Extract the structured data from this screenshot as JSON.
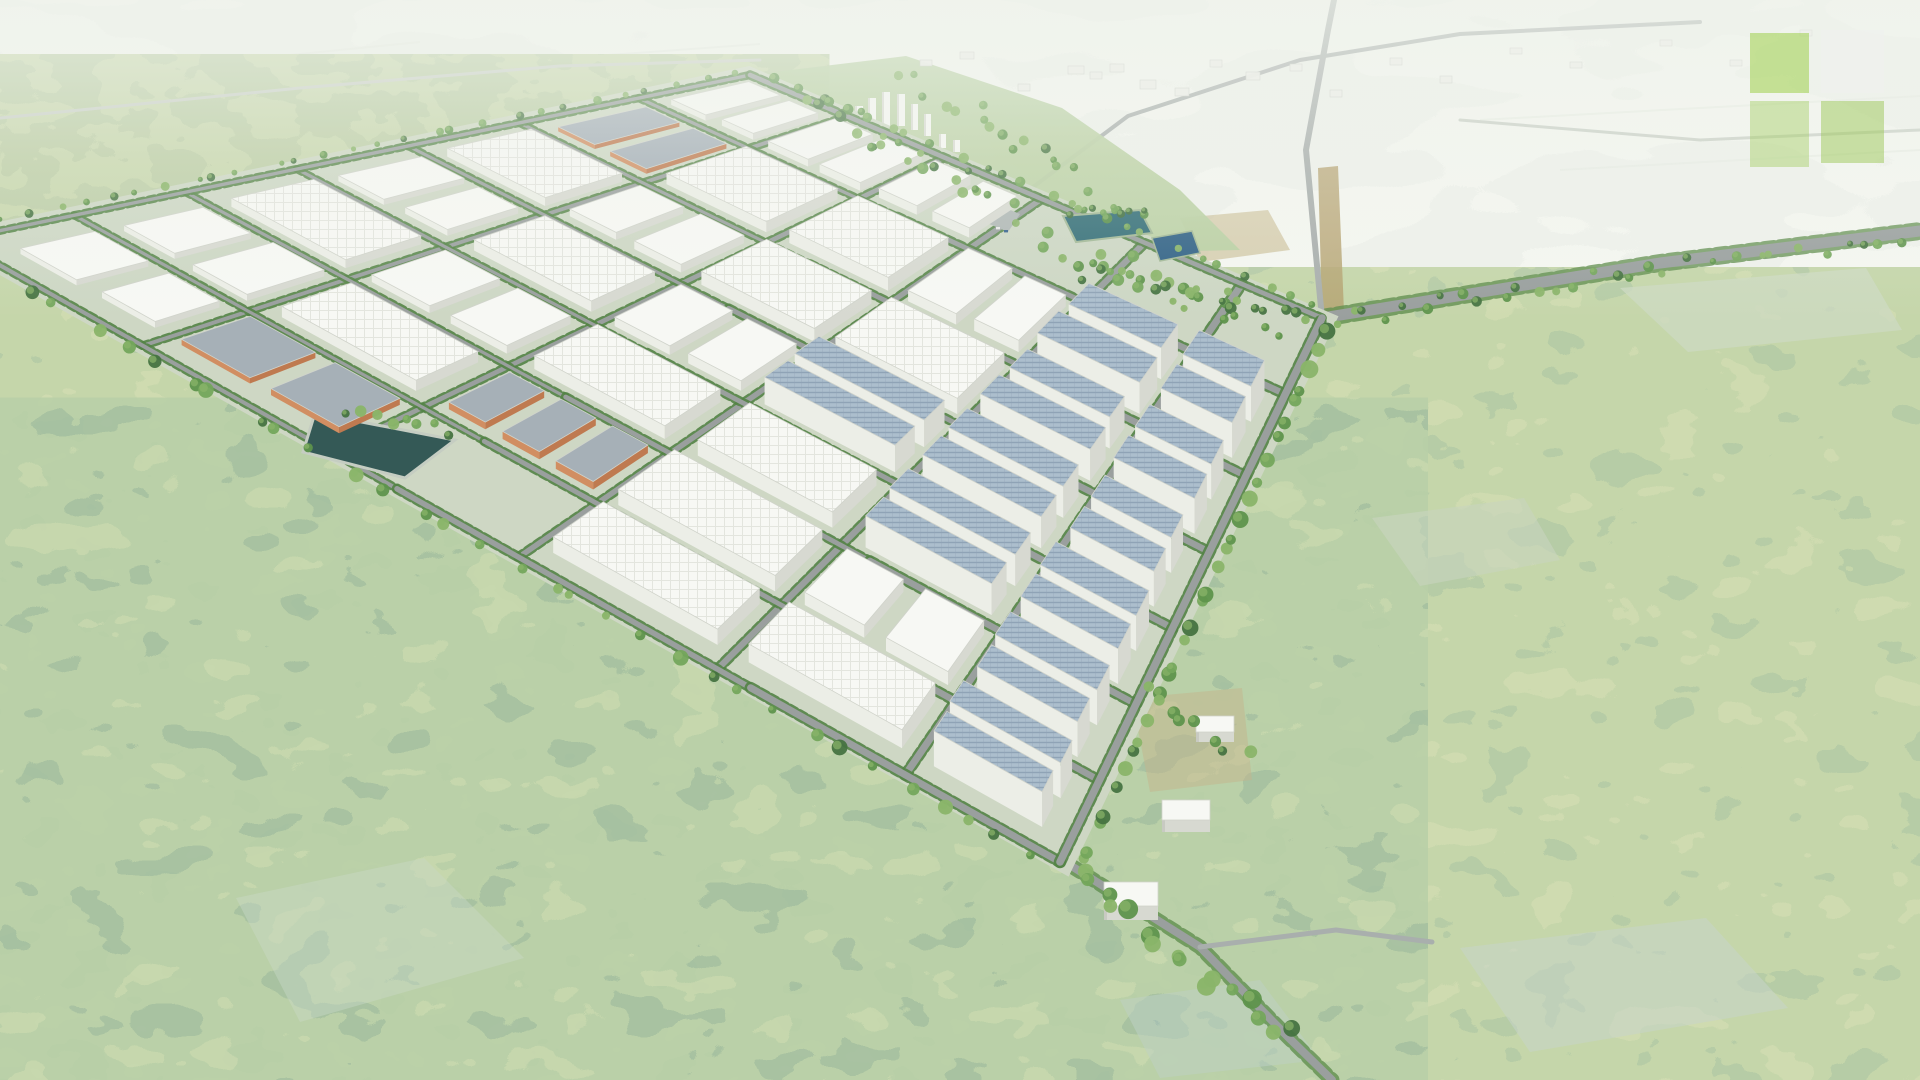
{
  "scene": {
    "alt": "Aerial 3D rendering of a planned industrial park with white warehouse blocks, orange buildings, solar rooftops, a street grid, retention ponds, surrounded by farmland and forest",
    "seed": 20240701
  },
  "palette": {
    "park_base": "#ccd6c2",
    "road": "#969c9b",
    "road_minor": "#a6acaa",
    "road_faint": "#c9cfc6",
    "hedge": "#4c7e3e",
    "verge": "#5a8a47",
    "white_roof": "#f7f8f4",
    "white_front": "#d6d8d0",
    "white_left": "#eceee6",
    "roof_line": "#e2e4dd",
    "orange_front": "#bd7549",
    "orange_left": "#d08a5c",
    "orange_roof": "#a3adb5",
    "solar_roof": "#a9bccb",
    "solar_stripe": "#8ba0b4",
    "pond": "#2c5350",
    "pond_edge": "#c3cbc0",
    "lake_a": "#2e6a74",
    "lake_b": "#2a5d82",
    "zone_green": "#b7cfa0",
    "plaza": "#aeb6b4",
    "tower_face": "#f6f7f3",
    "tower_shade": "#d8dad2",
    "trees": [
      "#3e6e3a",
      "#578f45",
      "#6fa355",
      "#86b264"
    ],
    "car_colors": [
      "#3c4450",
      "#a23b32",
      "#e8e8e8",
      "#2f5d8a",
      "#555555"
    ],
    "streak": "#e6ebe2",
    "haze": "238,242,235"
  },
  "filters": [
    {
      "id": "farmF",
      "freq": "0.005 0.013",
      "oct": 3,
      "seed": 11,
      "palette": [
        "#cdd8c7",
        "#dbe2d4",
        "#e7ebe0",
        "#c2cfbe"
      ]
    },
    {
      "id": "oliveF",
      "freq": "0.02 0.032",
      "oct": 3,
      "seed": 5,
      "palette": [
        "#6b8a52",
        "#7f9b5f",
        "#93ad68",
        "#a2b573"
      ]
    },
    {
      "id": "forestF",
      "freq": "0.017 0.027",
      "oct": 3,
      "seed": 7,
      "palette": [
        "#50794f",
        "#74985e",
        "#8caa64",
        "#9db36a",
        "#567e68"
      ]
    },
    {
      "id": "tealF",
      "freq": "0.015 0.025",
      "oct": 3,
      "seed": 9,
      "palette": [
        "#3d654d",
        "#5c8458",
        "#79a061",
        "#8fae68",
        "#4b7566"
      ]
    }
  ],
  "quad": {
    "W": [
      -45,
      240
    ],
    "N": [
      750,
      75
    ],
    "E": [
      1322,
      318
    ],
    "S": [
      1060,
      862
    ]
  },
  "grid": {
    "ucuts": [
      0.02,
      0.15,
      0.29,
      0.43,
      0.57,
      0.71,
      0.86,
      0.99
    ],
    "vcuts": [
      0.02,
      0.17,
      0.34,
      0.51,
      0.69,
      0.86,
      0.99
    ],
    "cellmap": [
      "2 2 1 2 1 o 2",
      "o 1 2 1 2 1 2",
      "p O 1 2 1 1 2",
      "1 1 1 r 1 2 g",
      "1 2 r r r r g",
      "r r r r r r g"
    ],
    "heights": {
      "shed": 14,
      "slab": 10,
      "orange": 8,
      "solar": 24
    }
  },
  "zones": {
    "farmland": [
      [
        0,
        0
      ],
      [
        1920,
        0
      ],
      [
        1920,
        240
      ],
      [
        1600,
        254
      ],
      [
        1380,
        240
      ],
      [
        1160,
        250
      ],
      [
        1040,
        222
      ],
      [
        900,
        140
      ],
      [
        760,
        66
      ],
      [
        520,
        98
      ],
      [
        240,
        142
      ],
      [
        0,
        178
      ]
    ],
    "olive_band": [
      [
        0,
        176
      ],
      [
        240,
        140
      ],
      [
        520,
        96
      ],
      [
        740,
        64
      ],
      [
        790,
        84
      ],
      [
        520,
        146
      ],
      [
        240,
        210
      ],
      [
        0,
        262
      ]
    ],
    "teal_overlay": [
      [
        0,
        430
      ],
      [
        310,
        440
      ],
      [
        700,
        640
      ],
      [
        1000,
        860
      ],
      [
        1360,
        1080
      ],
      [
        0,
        1080
      ]
    ],
    "town_green": [
      [
        758,
        74
      ],
      [
        906,
        56
      ],
      [
        1062,
        108
      ],
      [
        1180,
        190
      ],
      [
        1240,
        250
      ],
      [
        1150,
        252
      ],
      [
        1002,
        206
      ],
      [
        848,
        112
      ]
    ]
  },
  "clearings": [
    {
      "pts": [
        [
          1620,
          288
        ],
        [
          1866,
          268
        ],
        [
          1902,
          330
        ],
        [
          1688,
          352
        ]
      ],
      "c": "#cbd8c0",
      "o": 0.75
    },
    {
      "pts": [
        [
          1372,
          518
        ],
        [
          1524,
          498
        ],
        [
          1560,
          560
        ],
        [
          1420,
          586
        ]
      ],
      "c": "#c6d4bd",
      "o": 0.6
    },
    {
      "pts": [
        [
          1460,
          948
        ],
        [
          1706,
          918
        ],
        [
          1788,
          1008
        ],
        [
          1530,
          1052
        ]
      ],
      "c": "#c4d4c9",
      "o": 0.55
    },
    {
      "pts": [
        [
          236,
          898
        ],
        [
          424,
          858
        ],
        [
          524,
          958
        ],
        [
          300,
          1022
        ]
      ],
      "c": "#c7d6c4",
      "o": 0.45
    },
    {
      "pts": [
        [
          1120,
          1000
        ],
        [
          1260,
          980
        ],
        [
          1320,
          1060
        ],
        [
          1160,
          1078
        ]
      ],
      "c": "#bccfc4",
      "o": 0.5
    }
  ],
  "dirt_patches": [
    {
      "pts": [
        [
          1318,
          168
        ],
        [
          1338,
          166
        ],
        [
          1344,
          312
        ],
        [
          1322,
          314
        ]
      ],
      "c": "#b3a06c",
      "o": 0.85
    },
    {
      "pts": [
        [
          1132,
          698
        ],
        [
          1242,
          688
        ],
        [
          1252,
          780
        ],
        [
          1150,
          792
        ]
      ],
      "c": "#c2b288",
      "o": 0.5
    },
    {
      "pts": [
        [
          1180,
          218
        ],
        [
          1268,
          210
        ],
        [
          1290,
          250
        ],
        [
          1200,
          262
        ]
      ],
      "c": "#bfae7e",
      "o": 0.55
    }
  ],
  "streaks": [
    [
      0,
      128,
      520,
      74
    ],
    [
      60,
      176,
      640,
      108
    ],
    [
      0,
      84,
      420,
      42
    ],
    [
      540,
      60,
      760,
      44
    ],
    [
      1480,
      120,
      1920,
      96
    ],
    [
      1560,
      170,
      1920,
      150
    ]
  ],
  "roads": [
    {
      "pts": [
        [
          1322,
          318
        ],
        [
          1660,
          263
        ],
        [
          1920,
          231
        ]
      ],
      "w": 11,
      "minor": false,
      "verge": true
    },
    {
      "pts": [
        [
          1322,
          318
        ],
        [
          1306,
          150
        ],
        [
          1328,
          30
        ],
        [
          1334,
          0
        ]
      ],
      "w": 6,
      "minor": true,
      "verge": false
    },
    {
      "pts": [
        [
          1005,
          208
        ],
        [
          1128,
          116
        ],
        [
          1300,
          60
        ],
        [
          1460,
          34
        ],
        [
          1700,
          22
        ]
      ],
      "w": 4,
      "minor": true,
      "verge": false
    },
    {
      "pts": [
        [
          1073,
          867
        ],
        [
          1200,
          947
        ],
        [
          1288,
          1037
        ],
        [
          1332,
          1080
        ]
      ],
      "w": 8,
      "minor": false,
      "verge": true
    },
    {
      "pts": [
        [
          1200,
          947
        ],
        [
          1336,
          930
        ],
        [
          1432,
          942
        ]
      ],
      "w": 5,
      "minor": true,
      "verge": false
    },
    {
      "pts": [
        [
          0,
          118
        ],
        [
          300,
          88
        ],
        [
          560,
          66
        ],
        [
          760,
          60
        ]
      ],
      "w": 3,
      "minor": true,
      "verge": false,
      "faint": true
    },
    {
      "pts": [
        [
          1460,
          120
        ],
        [
          1700,
          140
        ],
        [
          1920,
          130
        ]
      ],
      "w": 3,
      "minor": true,
      "verge": false,
      "faint": true
    }
  ],
  "ponds": {
    "retention": [
      [
        315,
        413
      ],
      [
        455,
        440
      ],
      [
        405,
        478
      ],
      [
        303,
        452
      ]
    ],
    "lake_a": [
      [
        1063,
        216
      ],
      [
        1140,
        210
      ],
      [
        1152,
        233
      ],
      [
        1076,
        242
      ]
    ],
    "lake_b": [
      [
        1152,
        238
      ],
      [
        1192,
        231
      ],
      [
        1200,
        253
      ],
      [
        1160,
        261
      ]
    ]
  },
  "entrance": {
    "plaza": [
      [
        975,
        196
      ],
      [
        1020,
        214
      ],
      [
        1008,
        232
      ],
      [
        966,
        214
      ]
    ],
    "gate": [
      986,
      200,
      15,
      10
    ],
    "cars": [
      [
        952,
        204
      ],
      [
        946,
        209
      ],
      [
        996,
        227
      ],
      [
        1004,
        230
      ],
      [
        1012,
        222
      ]
    ]
  },
  "towers": [
    [
      843,
      140,
      8,
      26
    ],
    [
      855,
      136,
      8,
      30
    ],
    [
      868,
      132,
      8,
      34
    ],
    [
      882,
      128,
      8,
      36
    ],
    [
      897,
      126,
      8,
      32
    ],
    [
      911,
      130,
      7,
      26
    ],
    [
      924,
      136,
      7,
      22
    ],
    [
      874,
      158,
      9,
      18
    ],
    [
      892,
      156,
      9,
      20
    ],
    [
      909,
      154,
      8,
      16
    ],
    [
      939,
      148,
      7,
      14
    ],
    [
      953,
      152,
      7,
      12
    ]
  ],
  "hamlets": [
    [
      1068,
      66,
      16,
      8
    ],
    [
      1090,
      72,
      12,
      7
    ],
    [
      1110,
      64,
      14,
      8
    ],
    [
      1140,
      80,
      16,
      9
    ],
    [
      1175,
      88,
      14,
      8
    ],
    [
      1210,
      60,
      12,
      7
    ],
    [
      1246,
      72,
      14,
      8
    ],
    [
      1290,
      64,
      12,
      7
    ],
    [
      960,
      52,
      14,
      7
    ],
    [
      920,
      60,
      12,
      6
    ],
    [
      1018,
      84,
      12,
      7
    ],
    [
      1330,
      90,
      12,
      7
    ],
    [
      1390,
      58,
      12,
      7
    ],
    [
      1440,
      76,
      12,
      7
    ],
    [
      1510,
      48,
      12,
      6
    ],
    [
      1570,
      62,
      12,
      6
    ],
    [
      1660,
      40,
      12,
      6
    ],
    [
      1730,
      60,
      12,
      6
    ],
    [
      1800,
      30,
      12,
      6
    ]
  ],
  "outparcels": [
    {
      "x": 1196,
      "y": 716,
      "w": 38,
      "h": 16,
      "d": 10
    },
    {
      "x": 1162,
      "y": 800,
      "w": 48,
      "h": 20,
      "d": 12
    },
    {
      "x": 1104,
      "y": 882,
      "w": 54,
      "h": 24,
      "d": 14
    }
  ],
  "tree_lines": [
    {
      "edge": "v0",
      "off": -0.014,
      "n": 30,
      "rmin": 2.5,
      "rmax": 4.5
    },
    {
      "edge": "u1",
      "off": 1.014,
      "n": 24,
      "rmin": 3,
      "rmax": 5.5
    },
    {
      "edge": "u0",
      "off": -0.014,
      "n": 34,
      "rmin": 4,
      "rmax": 8
    },
    {
      "edge": "v1",
      "off": 1.016,
      "n": 30,
      "rmin": 5,
      "rmax": 9
    },
    {
      "a": [
        1100,
        270
      ],
      "b": [
        1322,
        322
      ],
      "n": 14,
      "j": 8,
      "rmin": 4,
      "rmax": 6
    },
    {
      "a": [
        1322,
        322
      ],
      "b": [
        1660,
        268
      ],
      "n": 18,
      "j": 8,
      "rmin": 3.5,
      "rmax": 5.5
    },
    {
      "a": [
        1660,
        268
      ],
      "b": [
        1916,
        236
      ],
      "n": 12,
      "j": 7,
      "rmin": 3,
      "rmax": 5
    },
    {
      "a": [
        1073,
        870
      ],
      "b": [
        1290,
        1040
      ],
      "n": 16,
      "j": 10,
      "rmin": 6,
      "rmax": 10
    },
    {
      "a": [
        806,
        108
      ],
      "b": [
        1006,
        198
      ],
      "n": 22,
      "j": 16,
      "rmin": 3.5,
      "rmax": 6
    },
    {
      "a": [
        902,
        76
      ],
      "b": [
        1128,
        208
      ],
      "n": 18,
      "j": 13,
      "rmin": 3,
      "rmax": 5.5
    },
    {
      "a": [
        1063,
        212
      ],
      "b": [
        1150,
        212
      ],
      "n": 10,
      "j": 5,
      "rmin": 3,
      "rmax": 4.5
    },
    {
      "a": [
        1020,
        230
      ],
      "b": [
        1240,
        300
      ],
      "n": 16,
      "j": 14,
      "rmin": 3.5,
      "rmax": 6
    },
    {
      "a": [
        1080,
        270
      ],
      "b": [
        1290,
        330
      ],
      "n": 12,
      "j": 10,
      "rmin": 3.5,
      "rmax": 6
    },
    {
      "a": [
        340,
        408
      ],
      "b": [
        460,
        432
      ],
      "n": 8,
      "j": 6,
      "rmin": 4,
      "rmax": 6
    },
    {
      "a": [
        1140,
        690
      ],
      "b": [
        1250,
        760
      ],
      "n": 8,
      "j": 8,
      "rmin": 4,
      "rmax": 7
    }
  ],
  "logo": {
    "x": 1750,
    "y": 30,
    "tiles": [
      {
        "dx": 0,
        "dy": 3,
        "w": 59,
        "h": 60,
        "color": "#9ed04a",
        "opacity": 0.55
      },
      {
        "dx": 71,
        "dy": 0,
        "w": 63,
        "h": 63,
        "color": "#eff1ed",
        "opacity": 0.85
      },
      {
        "dx": 0,
        "dy": 71,
        "w": 59,
        "h": 66,
        "color": "#a5cf63",
        "opacity": 0.45
      },
      {
        "dx": 71,
        "dy": 71,
        "w": 63,
        "h": 62,
        "color": "#9bc858",
        "opacity": 0.5
      }
    ]
  }
}
